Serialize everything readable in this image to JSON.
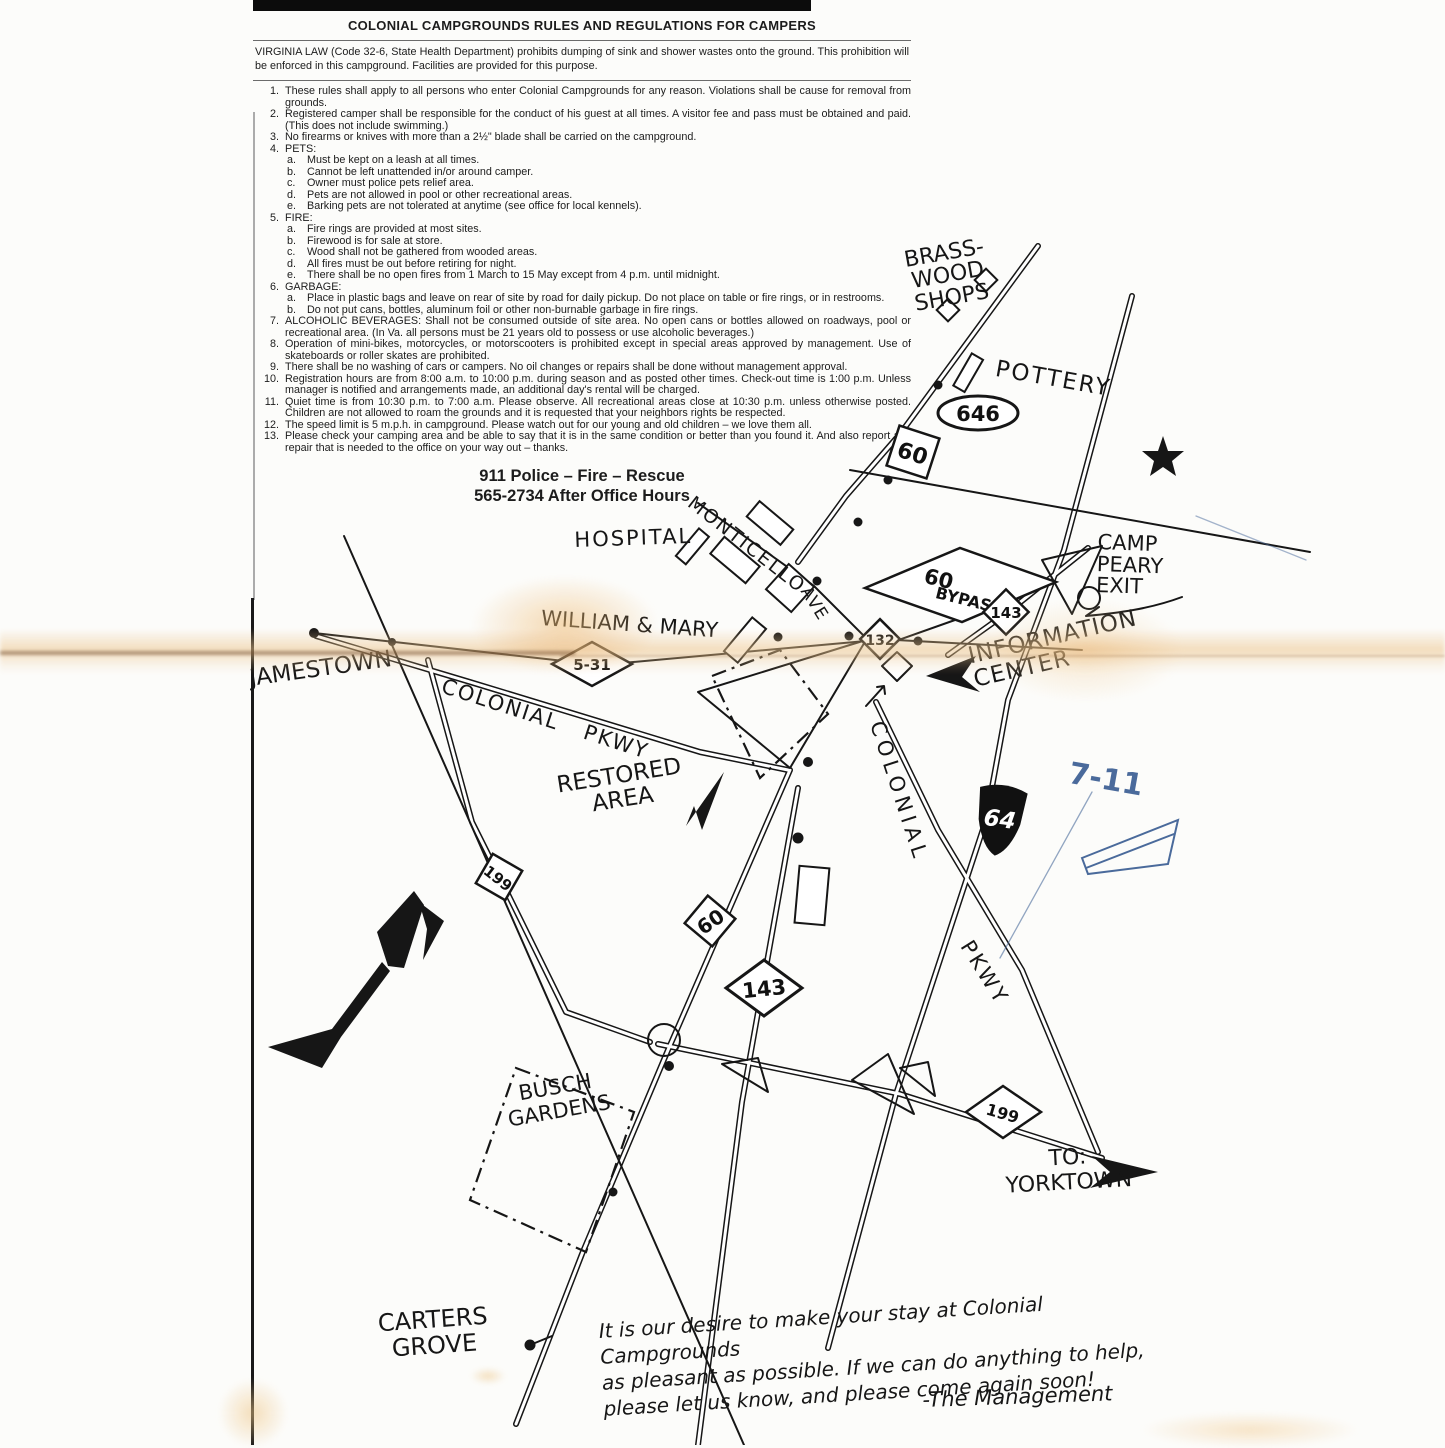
{
  "doc": {
    "title": "COLONIAL CAMPGROUNDS RULES AND REGULATIONS FOR CAMPERS",
    "intro": "VIRGINIA LAW (Code 32-6, State Health Department) prohibits dumping of sink and shower wastes onto the ground. This prohibition will be enforced in this campground. Facilities are provided for this purpose.",
    "rules": [
      {
        "num": "1.",
        "text": "These rules shall apply to all persons who enter Colonial Campgrounds for any reason. Violations shall be cause for removal from grounds.",
        "subs": []
      },
      {
        "num": "2.",
        "text": "Registered camper shall be responsible for the conduct of his guest at all times. A visitor fee and pass must be obtained and paid. (This does not include swimming.)",
        "subs": []
      },
      {
        "num": "3.",
        "text": "No firearms or knives with more than a 2½\" blade shall be carried on the campground.",
        "subs": []
      },
      {
        "num": "4.",
        "text": "PETS:",
        "subs": [
          {
            "letter": "a.",
            "text": "Must be kept on a leash at all times."
          },
          {
            "letter": "b.",
            "text": "Cannot be left unattended in/or around camper."
          },
          {
            "letter": "c.",
            "text": "Owner must police pets relief area."
          },
          {
            "letter": "d.",
            "text": "Pets are not allowed in pool or other recreational areas."
          },
          {
            "letter": "e.",
            "text": "Barking pets are not tolerated at anytime (see office for local kennels)."
          }
        ]
      },
      {
        "num": "5.",
        "text": "FIRE:",
        "subs": [
          {
            "letter": "a.",
            "text": "Fire rings are provided at most sites."
          },
          {
            "letter": "b.",
            "text": "Firewood is for sale at store."
          },
          {
            "letter": "c.",
            "text": "Wood shall not be gathered from wooded areas."
          },
          {
            "letter": "d.",
            "text": "All fires must be out before retiring for night."
          },
          {
            "letter": "e.",
            "text": "There shall be no open fires from 1 March to 15 May except from 4 p.m. until midnight."
          }
        ]
      },
      {
        "num": "6.",
        "text": "GARBAGE:",
        "subs": [
          {
            "letter": "a.",
            "text": "Place in plastic bags and leave on rear of site by road for daily pickup. Do not place on table or fire rings, or in restrooms."
          },
          {
            "letter": "b.",
            "text": "Do not put cans, bottles, aluminum foil or other non-burnable garbage in fire rings."
          }
        ]
      },
      {
        "num": "7.",
        "text": "ALCOHOLIC BEVERAGES: Shall not be consumed outside of site area. No open cans or bottles allowed on roadways, pool or recreational area. (In Va. all persons must be 21 years old to possess or use alcoholic beverages.)",
        "subs": []
      },
      {
        "num": "8.",
        "text": "Operation of mini-bikes, motorcycles, or motorscooters is prohibited except in special areas approved by management. Use of skateboards or roller skates are prohibited.",
        "subs": []
      },
      {
        "num": "9.",
        "text": "There shall be no washing of cars or campers. No oil changes or repairs shall be done without management approval.",
        "subs": []
      },
      {
        "num": "10.",
        "text": "Registration hours are from 8:00 a.m. to 10:00 p.m. during season and as posted other times. Check-out time is 1:00 p.m. Unless manager is notified and arrangements made, an additional day's rental will be charged.",
        "subs": []
      },
      {
        "num": "11.",
        "text": "Quiet time is from 10:30 p.m. to 7:00 a.m. Please observe. All recreational areas close at 10:30 p.m. unless otherwise posted. Children are not allowed to roam the grounds and it is requested that your neighbors rights be respected.",
        "subs": []
      },
      {
        "num": "12.",
        "text": "The speed limit is 5 m.p.h. in campground. Please watch out for our young and old children – we love them all.",
        "subs": []
      },
      {
        "num": "13.",
        "text": "Please check your camping area and be able to say that it is in the same condition or better than you found it. And also report any repair that is needed to the office on your way out – thanks.",
        "subs": []
      }
    ],
    "emergency_line1": "911 Police – Fire – Rescue",
    "emergency_line2": "565-2734 After Office Hours"
  },
  "map": {
    "colors": {
      "ink": "#161616",
      "blue_pen": "#4a6a9b",
      "stain": "#eec48c"
    },
    "shields": {
      "s60top": "60",
      "s646": "646",
      "s60bypass_top": "60",
      "s60bypass_bottom": "BYPASS",
      "s143top": "143",
      "s132": "132",
      "s531": "5-31",
      "s64": "64",
      "s60mid": "60",
      "s143mid": "143",
      "s199w": "199",
      "s199e": "199"
    },
    "labels": [
      {
        "id": "brass-wood-shops",
        "text": "BRASS-\nWOOD\nSHOPS",
        "x": 893,
        "y": 252,
        "rot": -10,
        "fs": 22,
        "lh": 1.02,
        "align": "center",
        "w": 100
      },
      {
        "id": "pottery",
        "text": "POTTERY",
        "x": 998,
        "y": 356,
        "rot": 10,
        "fs": 23,
        "ls": 2
      },
      {
        "id": "hospital",
        "text": "HOSPITAL",
        "x": 574,
        "y": 528,
        "rot": -2,
        "fs": 21,
        "ls": 2
      },
      {
        "id": "monticello",
        "text": "MONTICELLO",
        "x": 697,
        "y": 492,
        "rot": 38,
        "fs": 19,
        "ls": 2
      },
      {
        "id": "monticello-ave",
        "text": "AVE",
        "x": 813,
        "y": 583,
        "rot": 58,
        "fs": 17,
        "ls": 1
      },
      {
        "id": "camp-peary-exit",
        "text": "CAMP\nPEARY\nEXIT",
        "x": 1098,
        "y": 532,
        "rot": 2,
        "fs": 21,
        "lh": 1.03
      },
      {
        "id": "information-center",
        "text": "INFORMATION\nCENTER",
        "x": 966,
        "y": 645,
        "rot": -13,
        "fs": 23,
        "lh": 1.05,
        "ls": 1
      },
      {
        "id": "william-and-mary",
        "text": "WILLIAM & MARY",
        "x": 542,
        "y": 606,
        "rot": 4,
        "fs": 21
      },
      {
        "id": "jamestown",
        "text": "JAMESTOWN",
        "x": 248,
        "y": 666,
        "rot": -8,
        "fs": 23
      },
      {
        "id": "colonial-pkwy-west-1",
        "text": "COLONIAL",
        "x": 446,
        "y": 674,
        "rot": 18,
        "fs": 21,
        "ls": 2
      },
      {
        "id": "colonial-pkwy-west-2",
        "text": "PKWY",
        "x": 588,
        "y": 720,
        "rot": 18,
        "fs": 21,
        "ls": 2
      },
      {
        "id": "restored-area",
        "text": "RESTORED\nAREA",
        "x": 548,
        "y": 775,
        "rot": -9,
        "fs": 23,
        "lh": 1.05,
        "align": "center",
        "w": 140
      },
      {
        "id": "colonial-pkwy-east-1",
        "text": "COLONIAL",
        "x": 888,
        "y": 718,
        "rot": 72,
        "fs": 21,
        "ls": 5
      },
      {
        "id": "colonial-pkwy-east-2",
        "text": "PKWY",
        "x": 976,
        "y": 936,
        "rot": 58,
        "fs": 21,
        "ls": 3
      },
      {
        "id": "busch-gardens",
        "text": "BUSCH\nGARDENS",
        "x": 498,
        "y": 1086,
        "rot": -10,
        "fs": 21,
        "lh": 1.12,
        "align": "center",
        "w": 112
      },
      {
        "id": "to-yorktown",
        "text": "TO:\nYORKTOWN",
        "x": 998,
        "y": 1150,
        "rot": -3,
        "fs": 22,
        "lh": 1.12,
        "align": "center",
        "w": 138
      },
      {
        "id": "carters-grove",
        "text": "CARTERS\nGROVE",
        "x": 368,
        "y": 1312,
        "rot": -4,
        "fs": 24,
        "lh": 1.08,
        "align": "center",
        "w": 128
      },
      {
        "id": "seven-eleven",
        "text": "7-11",
        "x": 1072,
        "y": 756,
        "rot": 10,
        "fs": 30,
        "color": "blue",
        "cls": "pen"
      },
      {
        "id": "note-body",
        "text": "It is our desire to make your stay at Colonial Campgrounds\nas pleasant as possible. If we can do anything to help,\nplease let us know, and please come again soon!",
        "x": 598,
        "y": 1318,
        "rot": -3.5,
        "fs": 20,
        "lh": 1.3,
        "cls": "script",
        "w": 560
      },
      {
        "id": "note-signature",
        "text": "-The Management",
        "x": 922,
        "y": 1388,
        "rot": -2,
        "fs": 21,
        "cls": "script"
      }
    ]
  }
}
